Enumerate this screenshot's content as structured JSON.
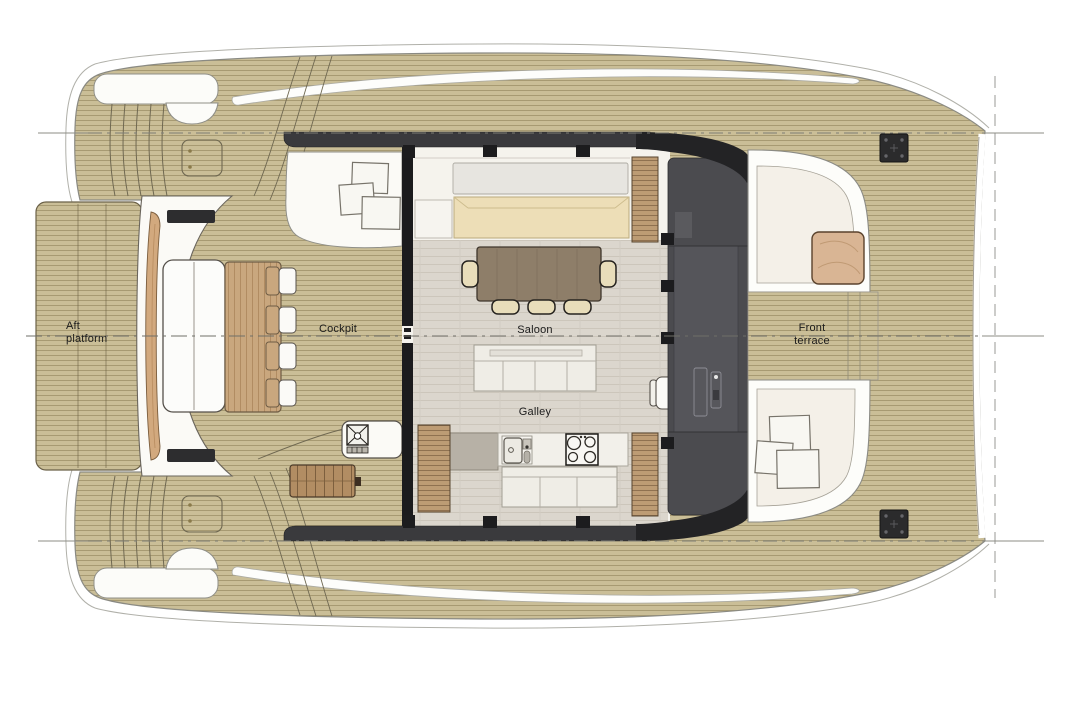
{
  "labels": {
    "aft_platform": "Aft platform",
    "cockpit": "Cockpit",
    "saloon": "Saloon",
    "galley": "Galley",
    "front_terrace": "Front terrace"
  },
  "colors": {
    "deck_wood": "#cabe97",
    "deck_plank_line": "#a79a72",
    "saloon_floor": "#dbd6cd",
    "dark_structure": "#3a3a3d",
    "bulkhead_gray": "#4b4b4f",
    "cushion_cream": "#eddeb7",
    "dining_table_wood": "#8e7e69",
    "terrace_table_wood": "#d9b594",
    "cabinet_wood": "#bd9c74",
    "hull_white": "#fcfcf9",
    "outline_dark": "#55504a"
  },
  "icons": [
    "cleat-icon",
    "mooring-bollard-icon",
    "deck-hatch-icon",
    "grill-icon",
    "stove-burners-icon",
    "sink-icon",
    "centerline-icon"
  ]
}
